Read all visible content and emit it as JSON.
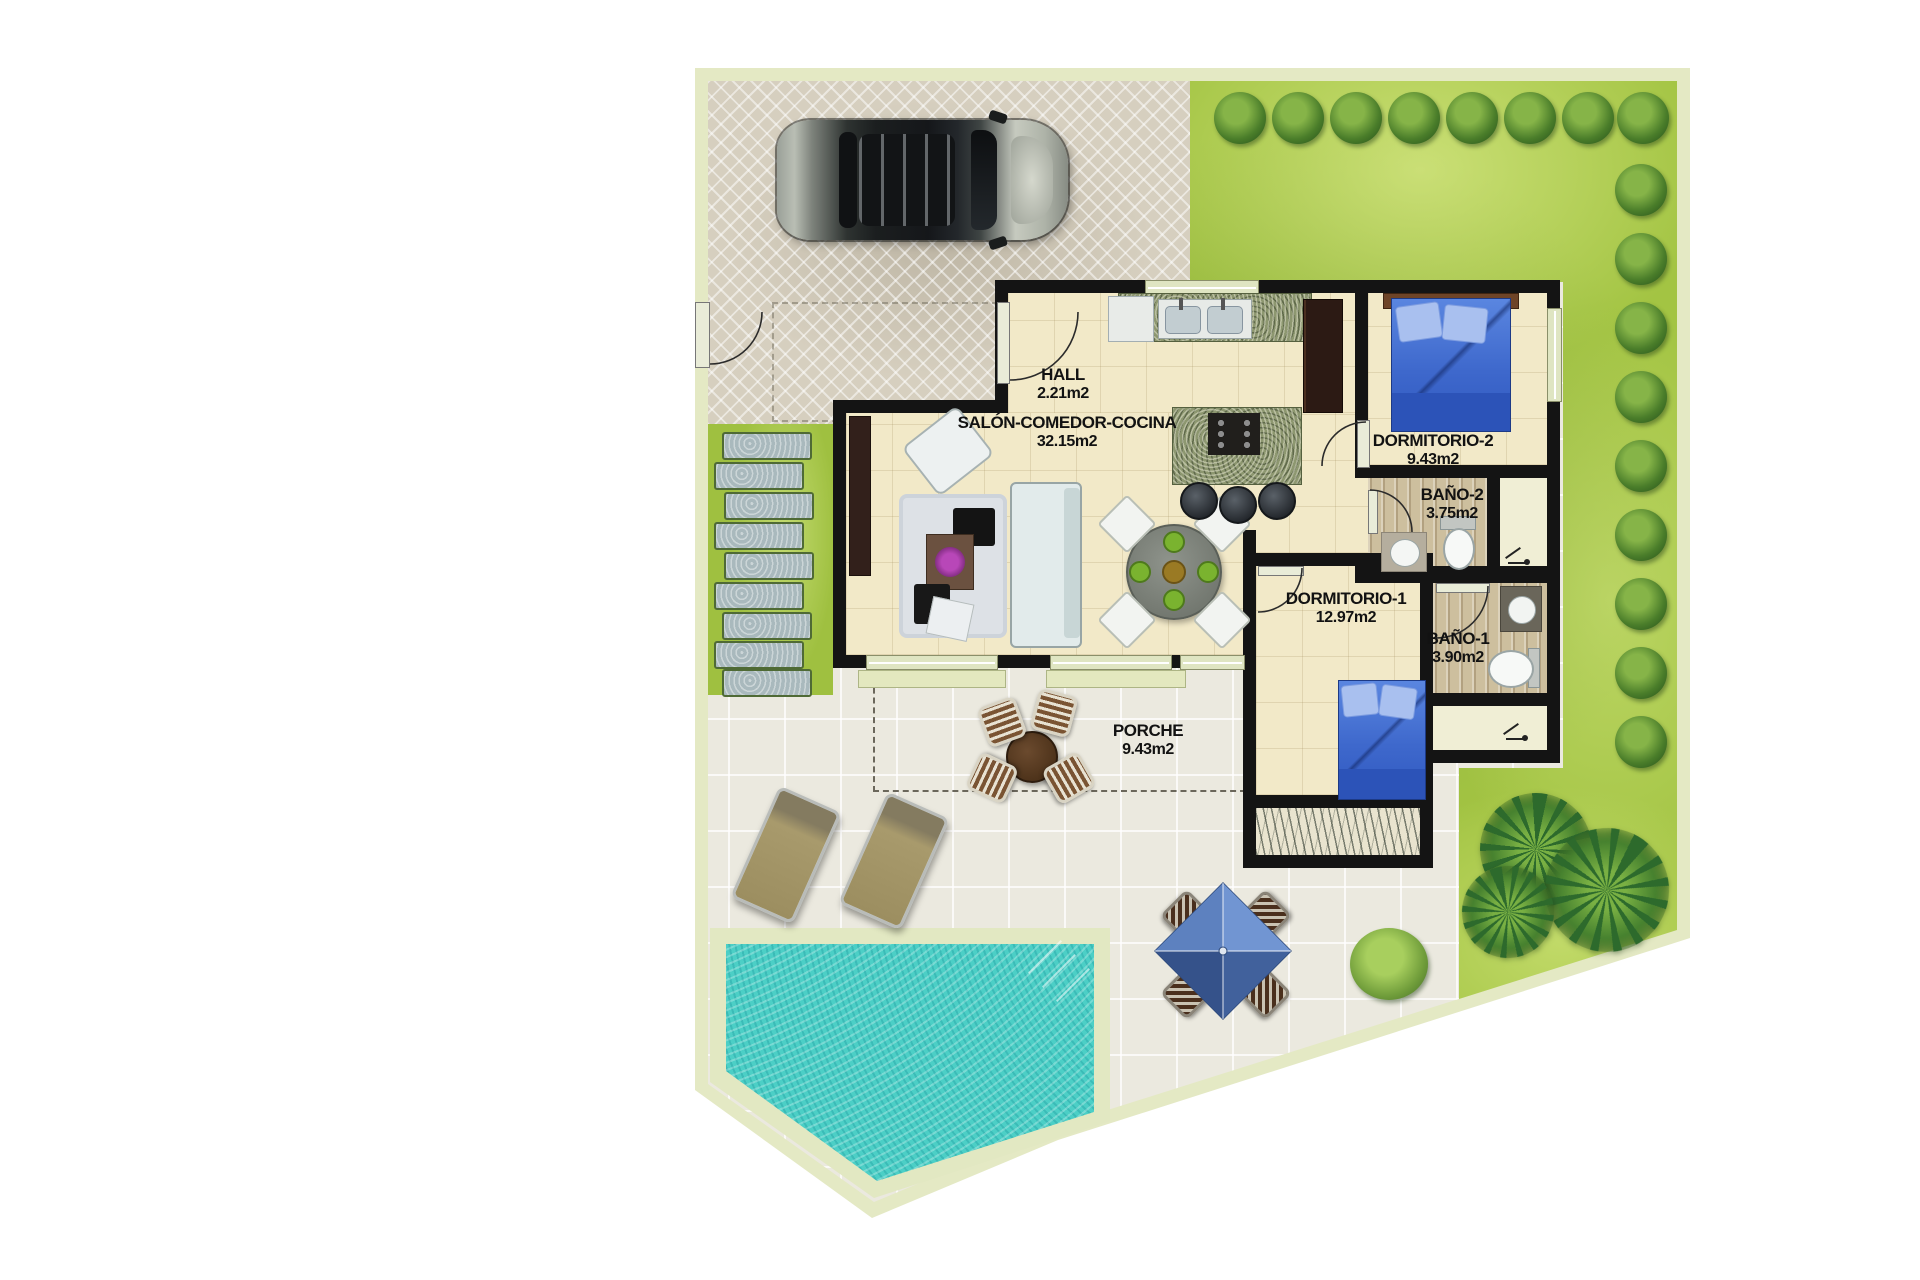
{
  "plan": {
    "type": "villa-floor-plan",
    "view": "top-down color render",
    "rooms": [
      {
        "id": "hall",
        "name": "HALL",
        "area": "2.21m2"
      },
      {
        "id": "salon-comedor-cocina",
        "name": "SALÓN-COMEDOR-COCINA",
        "area": "32.15m2"
      },
      {
        "id": "dormitorio-2",
        "name": "DORMITORIO-2",
        "area": "9.43m2"
      },
      {
        "id": "bano-2",
        "name": "BAÑO-2",
        "area": "3.75m2"
      },
      {
        "id": "dormitorio-1",
        "name": "DORMITORIO-1",
        "area": "12.97m2"
      },
      {
        "id": "bano-1",
        "name": "BAÑO-1",
        "area": "3.90m2"
      },
      {
        "id": "porche",
        "name": "PORCHE",
        "area": "9.43m2"
      }
    ],
    "outdoor_features": [
      "driveway",
      "car",
      "garden",
      "hedge-bushes",
      "stepping-stones",
      "swimming-pool",
      "porch",
      "sun-loungers",
      "outdoor-dining-set",
      "parasol-dining-set",
      "palm-trees"
    ],
    "colors": {
      "background": "#ffffff",
      "plot_wall": "#e4e9c4",
      "grass": "#a3c443",
      "driveway": "#d6cfbf",
      "patio": "#ebe9df",
      "house_floor": "#f2e9c8",
      "walls": "#141414",
      "pool_water": "#4ccfc6",
      "bed_linen": "#3e68cc",
      "bath_floor": "#cdbf9e"
    }
  }
}
